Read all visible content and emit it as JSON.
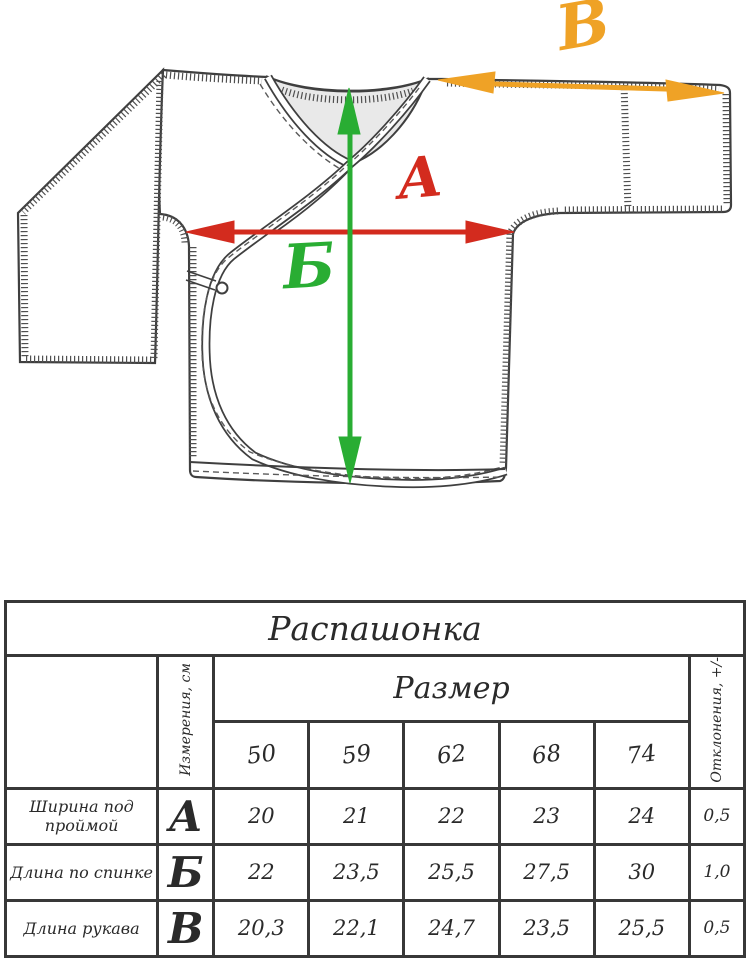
{
  "colors": {
    "a": "#d32b1e",
    "b": "#29ad33",
    "v": "#efa226",
    "ink": "#3f3f3f",
    "grid": "#383838"
  },
  "drawing": {
    "labels": {
      "a": "А",
      "b": "Б",
      "v": "В"
    }
  },
  "table": {
    "title": "Распашонка",
    "measure_col_label": "Измерения, см",
    "size_group_label": "Размер",
    "deviation_col_label": "Отклонения, +/-",
    "sizes": [
      "50",
      "59",
      "62",
      "68",
      "74"
    ],
    "rows": [
      {
        "label": "Ширина под проймой",
        "letter": "А",
        "values": [
          "20",
          "21",
          "22",
          "23",
          "24"
        ],
        "deviation": "0,5"
      },
      {
        "label": "Длина по спинке",
        "letter": "Б",
        "values": [
          "22",
          "23,5",
          "25,5",
          "27,5",
          "30"
        ],
        "deviation": "1,0"
      },
      {
        "label": "Длина рукава",
        "letter": "В",
        "values": [
          "20,3",
          "22,1",
          "24,7",
          "23,5",
          "25,5"
        ],
        "deviation": "0,5"
      }
    ]
  }
}
